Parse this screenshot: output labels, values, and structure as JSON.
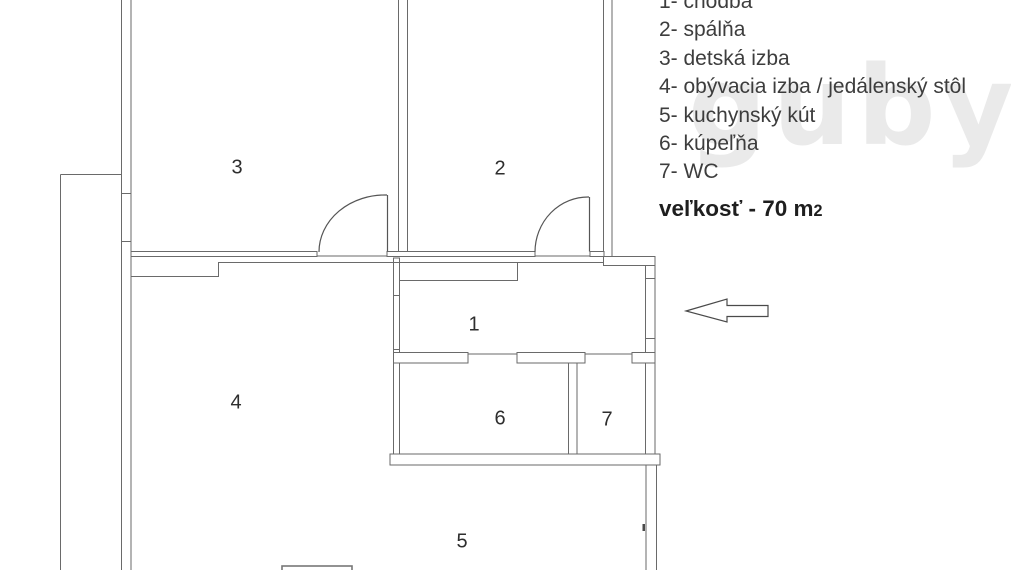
{
  "legend": {
    "items": [
      "1- chodba",
      "2- spálňa",
      "3- detská izba",
      "4- obývacia izba / jedálenský stôl",
      "5- kuchynský kút",
      "6- kúpeľňa",
      "7- WC"
    ]
  },
  "size_note": {
    "label": "veľkosť - 70 m",
    "exponent": "2"
  },
  "rooms": {
    "hallway": "1",
    "bedroom": "2",
    "kids_room": "3",
    "living_room": "4",
    "kitchen": "5",
    "bathroom": "6",
    "wc": "7"
  },
  "watermark": {
    "text": "guby",
    "reg": "®"
  },
  "colors": {
    "wall": "#6a6a6a",
    "text": "#3d3d3d"
  }
}
